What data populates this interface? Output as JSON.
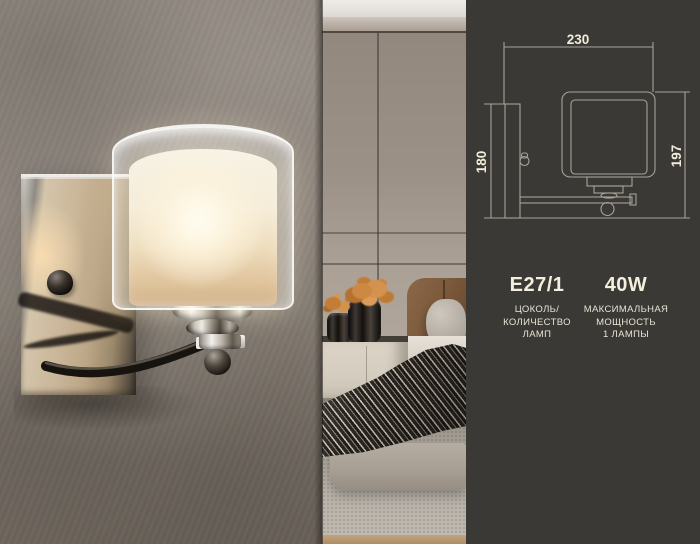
{
  "panel": {
    "diagram": {
      "width_mm": "230",
      "backplate_height_mm": "180",
      "total_height_mm": "197"
    },
    "specs": [
      {
        "value": "E27/1",
        "caption_lines": [
          "ЦОКОЛЬ/",
          "КОЛИЧЕСТВО",
          "ЛАМП"
        ]
      },
      {
        "value": "40W",
        "caption_lines": [
          "МАКСИМАЛЬНАЯ",
          "МОЩНОСТЬ",
          "1 ЛАМПЫ"
        ]
      }
    ],
    "colors": {
      "background": "#3a3936",
      "line": "#a7a396",
      "text": "#f2ecdb"
    }
  },
  "scene": {
    "left": "chrome-wall-sconce",
    "right": "bedroom-interior",
    "flower_accent": "#cd8844"
  }
}
